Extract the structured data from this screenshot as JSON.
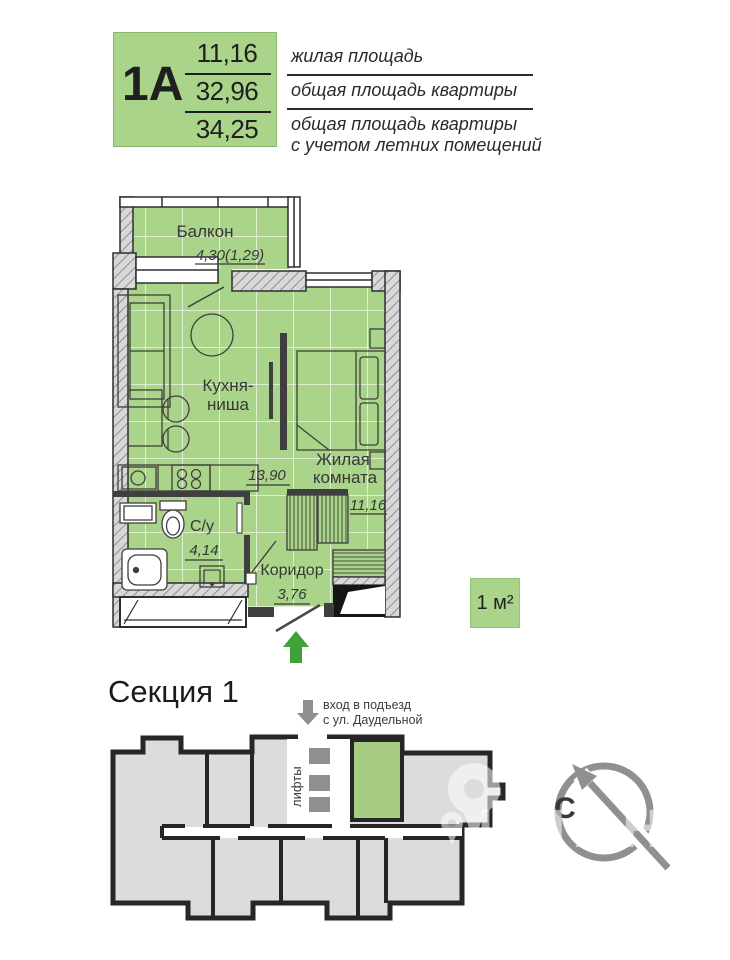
{
  "legend": {
    "unit": "1А",
    "living_area": "11,16",
    "total_area": "32,96",
    "total_area_summer": "34,25",
    "labels": {
      "living": "жилая площадь",
      "total": "общая площадь квартиры",
      "summer1": "общая площадь квартиры",
      "summer2": "с учетом летних помещений"
    }
  },
  "plan": {
    "balcony": {
      "name": "Балкон",
      "area": "4,30(1,29)"
    },
    "kitchen": {
      "name_line1": "Кухня-",
      "name_line2": "ниша",
      "area": "13,90"
    },
    "living": {
      "name_line1": "Жилая",
      "name_line2": "комната",
      "area": "11,16"
    },
    "bathroom": {
      "name": "С/у",
      "area": "4,14"
    },
    "corridor": {
      "name": "Коридор",
      "area": "3,76"
    }
  },
  "scale_box": {
    "label": "1 м²"
  },
  "section": {
    "title": "Секция 1",
    "entrance_line1": "вход в подъезд",
    "entrance_line2": "с ул. Даудельной",
    "elevators_label": "лифты",
    "compass_north": "С"
  },
  "watermark": {
    "text": "ЦИАН"
  },
  "colors": {
    "plan_green": "#aad489",
    "section_green": "#a6cd82",
    "entry_arrow_green": "#3fa13a",
    "gray": "#8f8f8f",
    "wall_dark": "#2e2e2e"
  }
}
